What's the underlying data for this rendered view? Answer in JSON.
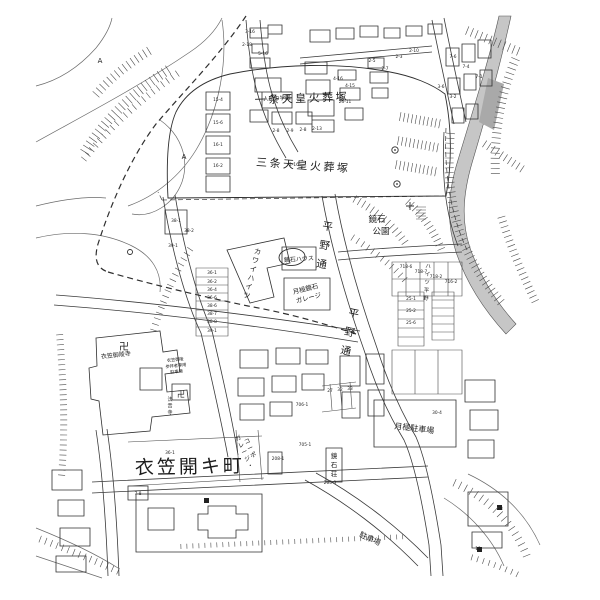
{
  "map": {
    "colors": {
      "background": "#ffffff",
      "line": "#3a3a3a",
      "river_gray": "#c6c6c6",
      "river_dark_gray": "#a9a9a9",
      "text": "#1c1c1c"
    },
    "labels": {
      "tomb_ichijo": "一条天皇火葬塚",
      "tomb_sanjo": "三条天皇火葬塚",
      "park_line1": "鏡石",
      "park_line2": "公園",
      "town": "衣笠開キ町",
      "street": "平野通",
      "house_kagamiishi": "鏡石ハウス",
      "garage_line1": "月極鏡石",
      "garage_line2": "ガレージ",
      "monthly_parking": "月極駐車場",
      "parking": "駐車場",
      "temple_main": "衣笠御陵寺",
      "temple_sub": "法音寺",
      "visitor_line1": "衣笠御陵",
      "visitor_line2": "参拝者専用",
      "visitor_line3": "駐車場",
      "school": "人形の学園",
      "swastika": "卍",
      "survey_mark": "A"
    },
    "vertical_labels": [
      {
        "text": "平野通",
        "x": 327,
        "y": 230,
        "step": 19,
        "fs": 10.5,
        "rot": 9
      },
      {
        "text": "平野通",
        "x": 353,
        "y": 317,
        "step": 19,
        "fs": 10.5,
        "rot": 12
      },
      {
        "text": "カワイハイツ",
        "x": 257,
        "y": 254,
        "step": 9,
        "fs": 7,
        "rot": 14
      },
      {
        "text": "ハイツ平野",
        "x": 428,
        "y": 268,
        "step": 8,
        "fs": 5.5,
        "rot": 4
      },
      {
        "text": "鏡石荘",
        "x": 334,
        "y": 458,
        "step": 9,
        "fs": 6.5,
        "rot": 0
      },
      {
        "text": "法音寺",
        "x": 170,
        "y": 401,
        "step": 6.5,
        "fs": 5,
        "rot": 0
      },
      {
        "text": "ガレージ・",
        "x": 239,
        "y": 440,
        "step": 7.5,
        "fs": 6,
        "rot": -24
      },
      {
        "text": "コーポ",
        "x": 248,
        "y": 443,
        "step": 7.5,
        "fs": 6,
        "rot": -24
      }
    ],
    "parcel_numbers": [
      {
        "t": "3-16",
        "x": 250,
        "y": 33
      },
      {
        "t": "2-18",
        "x": 247,
        "y": 46
      },
      {
        "t": "5-16",
        "x": 263,
        "y": 55
      },
      {
        "t": "2-8",
        "x": 276,
        "y": 132
      },
      {
        "t": "2-9",
        "x": 290,
        "y": 132
      },
      {
        "t": "2-8",
        "x": 303,
        "y": 131
      },
      {
        "t": "2-13",
        "x": 317,
        "y": 130
      },
      {
        "t": "4-16",
        "x": 338,
        "y": 80
      },
      {
        "t": "4-15",
        "x": 350,
        "y": 87
      },
      {
        "t": "25-11",
        "x": 345,
        "y": 103
      },
      {
        "t": "2-5",
        "x": 372,
        "y": 62
      },
      {
        "t": "2-7",
        "x": 385,
        "y": 70
      },
      {
        "t": "2-3",
        "x": 399,
        "y": 58
      },
      {
        "t": "2-10",
        "x": 414,
        "y": 52
      },
      {
        "t": "7-6",
        "x": 453,
        "y": 58
      },
      {
        "t": "7-4",
        "x": 466,
        "y": 68
      },
      {
        "t": "7-1",
        "x": 479,
        "y": 78
      },
      {
        "t": "3-6",
        "x": 441,
        "y": 88
      },
      {
        "t": "3-2",
        "x": 453,
        "y": 98
      },
      {
        "t": "15-4",
        "x": 218,
        "y": 101
      },
      {
        "t": "15-6",
        "x": 218,
        "y": 124
      },
      {
        "t": "16-1",
        "x": 218,
        "y": 146
      },
      {
        "t": "16-2",
        "x": 218,
        "y": 167
      },
      {
        "t": "2-16",
        "x": 294,
        "y": 166
      },
      {
        "t": "38-1",
        "x": 176,
        "y": 222
      },
      {
        "t": "38-2",
        "x": 189,
        "y": 232
      },
      {
        "t": "39-1",
        "x": 173,
        "y": 247
      },
      {
        "t": "36-1",
        "x": 212,
        "y": 274
      },
      {
        "t": "36-2",
        "x": 212,
        "y": 283
      },
      {
        "t": "36-4",
        "x": 212,
        "y": 291
      },
      {
        "t": "36-6",
        "x": 212,
        "y": 299
      },
      {
        "t": "38-6",
        "x": 212,
        "y": 307
      },
      {
        "t": "38-7",
        "x": 212,
        "y": 315
      },
      {
        "t": "38-8",
        "x": 212,
        "y": 323
      },
      {
        "t": "39-1",
        "x": 212,
        "y": 332
      },
      {
        "t": "718-6",
        "x": 406,
        "y": 268
      },
      {
        "t": "718-7",
        "x": 421,
        "y": 273
      },
      {
        "t": "718-2",
        "x": 436,
        "y": 278
      },
      {
        "t": "716-2",
        "x": 451,
        "y": 283
      },
      {
        "t": "25-1",
        "x": 411,
        "y": 300
      },
      {
        "t": "25-2",
        "x": 411,
        "y": 312
      },
      {
        "t": "25-6",
        "x": 411,
        "y": 324
      },
      {
        "t": "27",
        "x": 330,
        "y": 392
      },
      {
        "t": "32",
        "x": 340,
        "y": 391
      },
      {
        "t": "33",
        "x": 350,
        "y": 390
      },
      {
        "t": "706-1",
        "x": 302,
        "y": 406
      },
      {
        "t": "705-1",
        "x": 305,
        "y": 446
      },
      {
        "t": "205-3",
        "x": 330,
        "y": 484
      },
      {
        "t": "208-1",
        "x": 278,
        "y": 460
      },
      {
        "t": "36-1",
        "x": 170,
        "y": 454
      },
      {
        "t": "30-4",
        "x": 437,
        "y": 414
      },
      {
        "t": "7-8",
        "x": 138,
        "y": 495
      },
      {
        "t": "18",
        "x": 500,
        "y": 510
      },
      {
        "t": "19",
        "x": 478,
        "y": 550
      }
    ]
  }
}
